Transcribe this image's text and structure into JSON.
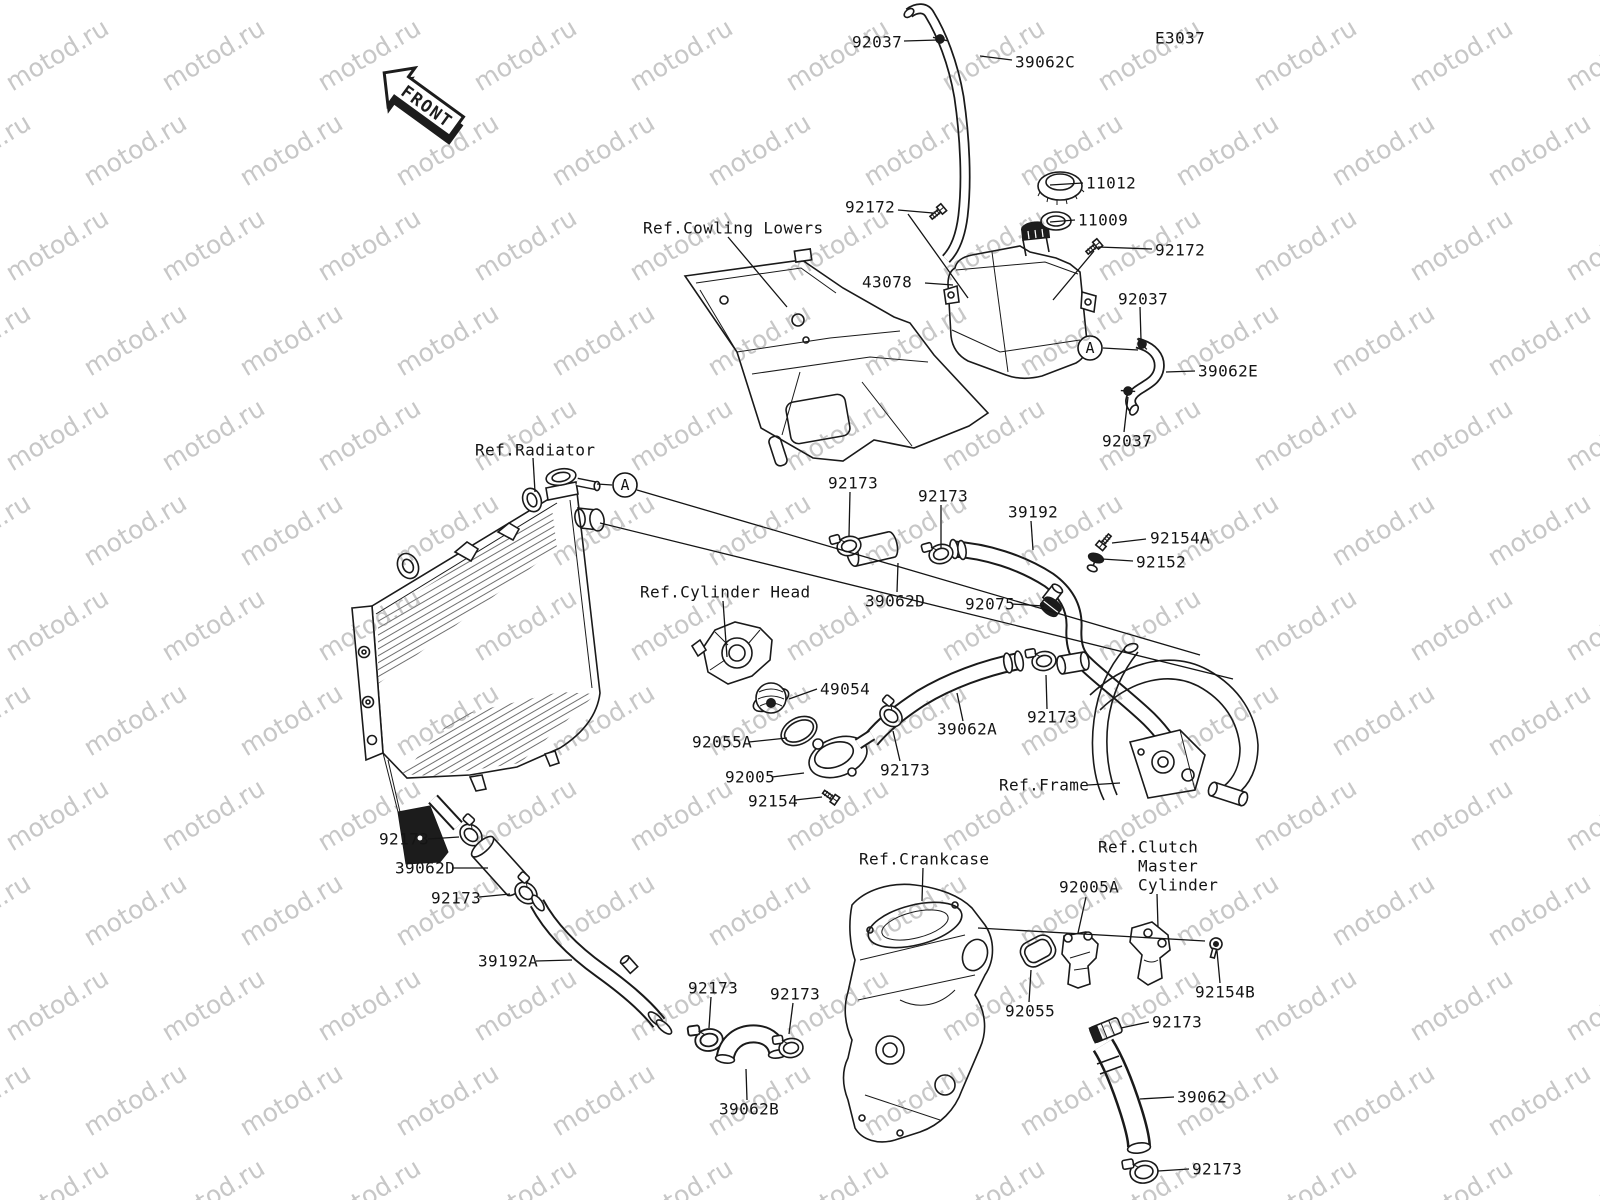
{
  "diagram": {
    "code_note": "diagram code shown top-right is in part_labels",
    "front_label": "FRONT",
    "line_color": "#1a1a1a",
    "watermark": {
      "text": "motod.ru",
      "color": "#c7c7c7",
      "angle_deg": -31,
      "font_size": 25,
      "x_step": 156,
      "y_step": 95
    }
  },
  "part_labels": [
    {
      "name": "label-92037-top",
      "text": "92037",
      "x": 852,
      "y": 42
    },
    {
      "name": "label-39062C",
      "text": "39062C",
      "x": 1015,
      "y": 62
    },
    {
      "name": "diagram-code",
      "text": "E3037",
      "x": 1155,
      "y": 38
    },
    {
      "name": "label-92172-left",
      "text": "92172",
      "x": 845,
      "y": 207
    },
    {
      "name": "label-11012",
      "text": "11012",
      "x": 1086,
      "y": 183
    },
    {
      "name": "label-11009",
      "text": "11009",
      "x": 1078,
      "y": 220
    },
    {
      "name": "label-92172-right",
      "text": "92172",
      "x": 1155,
      "y": 250
    },
    {
      "name": "label-43078",
      "text": "43078",
      "x": 862,
      "y": 282
    },
    {
      "name": "label-92037-mid",
      "text": "92037",
      "x": 1118,
      "y": 299
    },
    {
      "name": "label-39062E",
      "text": "39062E",
      "x": 1198,
      "y": 371
    },
    {
      "name": "label-92037-low",
      "text": "92037",
      "x": 1102,
      "y": 441
    },
    {
      "name": "label-92173-1",
      "text": "92173",
      "x": 828,
      "y": 483
    },
    {
      "name": "label-92173-2",
      "text": "92173",
      "x": 918,
      "y": 496
    },
    {
      "name": "label-39192",
      "text": "39192",
      "x": 1008,
      "y": 512
    },
    {
      "name": "label-92154A",
      "text": "92154A",
      "x": 1150,
      "y": 538
    },
    {
      "name": "label-92152",
      "text": "92152",
      "x": 1136,
      "y": 562
    },
    {
      "name": "label-39062D-mid",
      "text": "39062D",
      "x": 865,
      "y": 601
    },
    {
      "name": "label-92075",
      "text": "92075",
      "x": 965,
      "y": 604
    },
    {
      "name": "label-49054",
      "text": "49054",
      "x": 820,
      "y": 689
    },
    {
      "name": "label-92055A",
      "text": "92055A",
      "x": 692,
      "y": 742
    },
    {
      "name": "label-92005",
      "text": "92005",
      "x": 725,
      "y": 777
    },
    {
      "name": "label-92154",
      "text": "92154",
      "x": 748,
      "y": 801
    },
    {
      "name": "label-92173-3",
      "text": "92173",
      "x": 880,
      "y": 770
    },
    {
      "name": "label-39062A",
      "text": "39062A",
      "x": 937,
      "y": 729
    },
    {
      "name": "label-92173-4",
      "text": "92173",
      "x": 1027,
      "y": 717
    },
    {
      "name": "label-92173-5",
      "text": "92173",
      "x": 379,
      "y": 839
    },
    {
      "name": "label-39062D-left",
      "text": "39062D",
      "x": 395,
      "y": 868
    },
    {
      "name": "label-92173-6",
      "text": "92173",
      "x": 431,
      "y": 898
    },
    {
      "name": "label-39192A",
      "text": "39192A",
      "x": 478,
      "y": 961
    },
    {
      "name": "label-92173-7",
      "text": "92173",
      "x": 688,
      "y": 988
    },
    {
      "name": "label-92173-8",
      "text": "92173",
      "x": 770,
      "y": 994
    },
    {
      "name": "label-39062B",
      "text": "39062B",
      "x": 719,
      "y": 1109
    },
    {
      "name": "label-92005A",
      "text": "92005A",
      "x": 1059,
      "y": 887
    },
    {
      "name": "label-92055",
      "text": "92055",
      "x": 1005,
      "y": 1011
    },
    {
      "name": "label-92154B",
      "text": "92154B",
      "x": 1195,
      "y": 992
    },
    {
      "name": "label-92173-9",
      "text": "92173",
      "x": 1152,
      "y": 1022
    },
    {
      "name": "label-39062",
      "text": "39062",
      "x": 1177,
      "y": 1097
    },
    {
      "name": "label-92173-10",
      "text": "92173",
      "x": 1192,
      "y": 1169
    }
  ],
  "ref_labels": [
    {
      "name": "ref-cowling-lowers",
      "text": "Ref.Cowling Lowers",
      "x": 643,
      "y": 228
    },
    {
      "name": "ref-radiator",
      "text": "Ref.Radiator",
      "x": 475,
      "y": 450
    },
    {
      "name": "ref-cylinder-head",
      "text": "Ref.Cylinder Head",
      "x": 640,
      "y": 592
    },
    {
      "name": "ref-frame",
      "text": "Ref.Frame",
      "x": 999,
      "y": 785
    },
    {
      "name": "ref-crankcase",
      "text": "Ref.Crankcase",
      "x": 859,
      "y": 859
    },
    {
      "name": "ref-clutch-line1",
      "text": "Ref.Clutch",
      "x": 1098,
      "y": 847
    },
    {
      "name": "ref-clutch-line2",
      "text": "Master",
      "x": 1138,
      "y": 866
    },
    {
      "name": "ref-clutch-line3",
      "text": "Cylinder",
      "x": 1138,
      "y": 885
    }
  ],
  "markers": [
    {
      "label": "A",
      "x": 1090,
      "y": 348
    },
    {
      "label": "A",
      "x": 625,
      "y": 485
    }
  ],
  "leader_lines": [
    [
      904,
      41,
      938,
      40
    ],
    [
      1012,
      60,
      980,
      56
    ],
    [
      898,
      210,
      933,
      213
    ],
    [
      908,
      214,
      968,
      298
    ],
    [
      1083,
      183,
      1050,
      185
    ],
    [
      1075,
      220,
      1050,
      222
    ],
    [
      1152,
      249,
      1098,
      247
    ],
    [
      1094,
      251,
      1053,
      300
    ],
    [
      925,
      283,
      953,
      285
    ],
    [
      1140,
      307,
      1141,
      340
    ],
    [
      1103,
      348,
      1138,
      350
    ],
    [
      1195,
      371,
      1166,
      372
    ],
    [
      1124,
      432,
      1128,
      397
    ],
    [
      728,
      237,
      787,
      307
    ],
    [
      533,
      458,
      535,
      492
    ],
    [
      612,
      485,
      597,
      484
    ],
    [
      850,
      492,
      849,
      536
    ],
    [
      941,
      505,
      941,
      548
    ],
    [
      1031,
      521,
      1033,
      550
    ],
    [
      1146,
      539,
      1112,
      543
    ],
    [
      1133,
      561,
      1102,
      559
    ],
    [
      897,
      592,
      898,
      563
    ],
    [
      1012,
      604,
      1044,
      606
    ],
    [
      723,
      601,
      727,
      657
    ],
    [
      817,
      689,
      789,
      699
    ],
    [
      749,
      742,
      787,
      738
    ],
    [
      772,
      777,
      804,
      773
    ],
    [
      795,
      800,
      822,
      797
    ],
    [
      900,
      761,
      893,
      731
    ],
    [
      963,
      721,
      957,
      693
    ],
    [
      1047,
      709,
      1046,
      675
    ],
    [
      1088,
      785,
      1120,
      783
    ],
    [
      428,
      839,
      459,
      837
    ],
    [
      452,
      868,
      488,
      868
    ],
    [
      479,
      897,
      510,
      894
    ],
    [
      536,
      961,
      572,
      960
    ],
    [
      711,
      997,
      709,
      1028
    ],
    [
      793,
      1003,
      789,
      1034
    ],
    [
      747,
      1100,
      746,
      1069
    ],
    [
      923,
      868,
      922,
      901
    ],
    [
      1086,
      897,
      1078,
      933
    ],
    [
      1157,
      894,
      1158,
      927
    ],
    [
      1029,
      1002,
      1031,
      970
    ],
    [
      1220,
      983,
      1217,
      951
    ],
    [
      1149,
      1022,
      1121,
      1028
    ],
    [
      1174,
      1097,
      1140,
      1099
    ],
    [
      1189,
      1169,
      1158,
      1171
    ],
    [
      637,
      490,
      1200,
      655
    ],
    [
      600,
      523,
      1233,
      679
    ],
    [
      978,
      928,
      1205,
      941
    ]
  ]
}
